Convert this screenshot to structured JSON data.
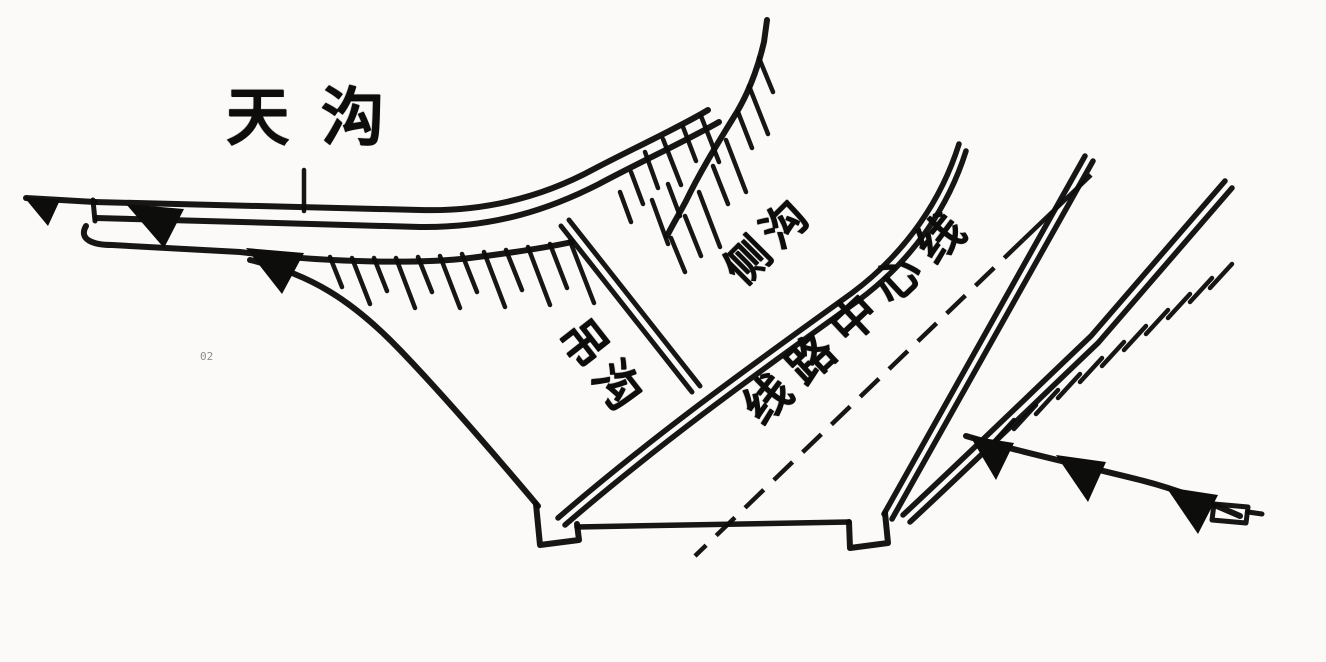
{
  "diagram": {
    "labels": {
      "top_ditch": "天沟",
      "chute": "吊沟",
      "side_ditch": "侧沟",
      "center_line": "线路中心线"
    },
    "colors": {
      "ink": "#0d0d0c",
      "paper": "#fbfaf8"
    }
  }
}
